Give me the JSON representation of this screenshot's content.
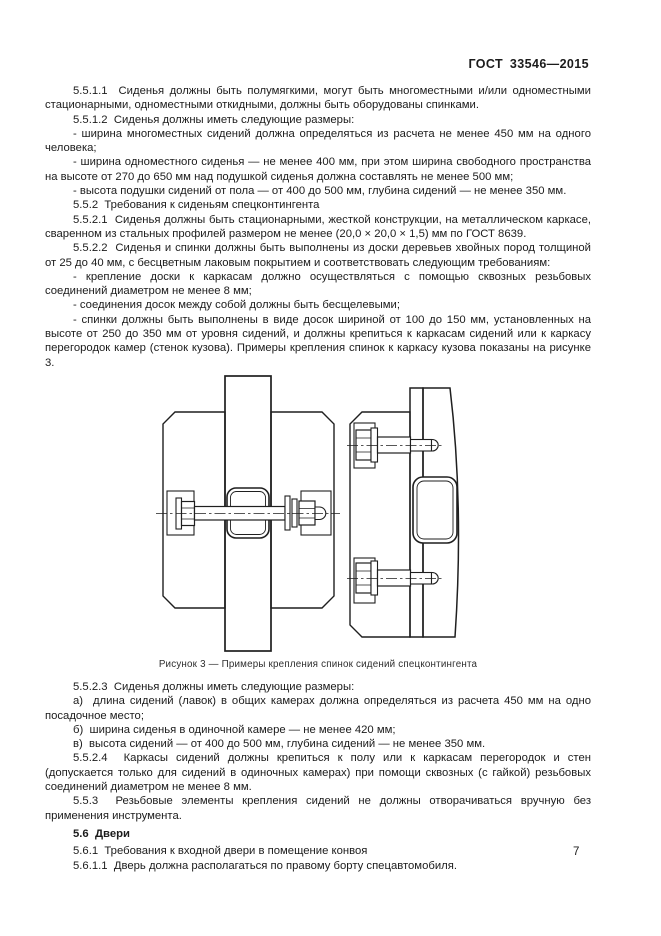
{
  "header": {
    "doc_code": "ГОСТ  33546—2015"
  },
  "paragraphs": [
    {
      "text": "5.5.1.1  Сиденья должны быть полумягкими, могут быть многоместными и/или одноместными стационарными, одноместными откидными, должны быть оборудованы спинками."
    },
    {
      "text": "5.5.1.2  Сиденья должны иметь следующие размеры:"
    },
    {
      "text": "- ширина многоместных сидений должна определяться из расчета не менее 450 мм на одного человека;"
    },
    {
      "text": "- ширина одноместного сиденья — не менее 400 мм, при этом ширина свободного пространства на высоте от 270 до 650 мм над подушкой сиденья должна составлять не менее 500 мм;"
    },
    {
      "text": "- высота подушки сидений от пола — от 400 до 500 мм, глубина сидений — не менее 350 мм."
    },
    {
      "text": "5.5.2  Требования к сиденьям спецконтингента"
    },
    {
      "text": "5.5.2.1  Сиденья должны быть стационарными, жесткой конструкции, на металлическом каркасе, сваренном из стальных профилей размером не менее (20,0 × 20,0 × 1,5) мм по ГОСТ 8639."
    },
    {
      "text": "5.5.2.2  Сиденья и спинки должны быть выполнены из доски деревьев хвойных пород толщиной от 25 до 40 мм, с бесцветным лаковым покрытием и соответствовать следующим требованиям:"
    },
    {
      "text": "- крепление доски к каркасам должно осуществляться с помощью сквозных резьбовых соединений диаметром не менее 8 мм;"
    },
    {
      "text": "- соединения досок между собой должны быть бесщелевыми;"
    },
    {
      "text": "- спинки должны быть выполнены в виде досок шириной от 100 до 150 мм, установленных на высоте от 250 до 350 мм от уровня сидений, и должны крепиться к каркасам сидений или к каркасу перегородок камер (стенок кузова). Примеры крепления спинок к каркасу кузова показаны на рисунке 3."
    },
    {
      "text": "5.5.2.3  Сиденья должны иметь следующие размеры:"
    },
    {
      "text": "а)  длина сидений (лавок) в общих камерах должна определяться из расчета 450 мм на одно посадочное место;"
    },
    {
      "text": "б)  ширина сиденья в одиночной камере — не менее 420 мм;"
    },
    {
      "text": "в)  высота сидений — от 400 до 500 мм, глубина сидений — не менее 350 мм."
    },
    {
      "text": "5.5.2.4  Каркасы сидений должны крепиться к полу или к каркасам перегородок и стен (допускается только для сидений в одиночных камерах) при помощи сквозных (с гайкой) резьбовых соединений диаметром не менее 8 мм."
    },
    {
      "text": "5.5.3  Резьбовые элементы крепления сидений не должны отворачиваться вручную без применения инструмента."
    },
    {
      "text": "5.6  Двери"
    },
    {
      "text": "5.6.1  Требования к входной двери в помещение конвоя"
    },
    {
      "text": "5.6.1.1  Дверь должна располагаться по правому борту спецавтомобиля."
    }
  ],
  "figure": {
    "caption": "Рисунок 3 — Примеры крепления спинок сидений спецконтингента"
  },
  "footer": {
    "page_number": "7"
  }
}
